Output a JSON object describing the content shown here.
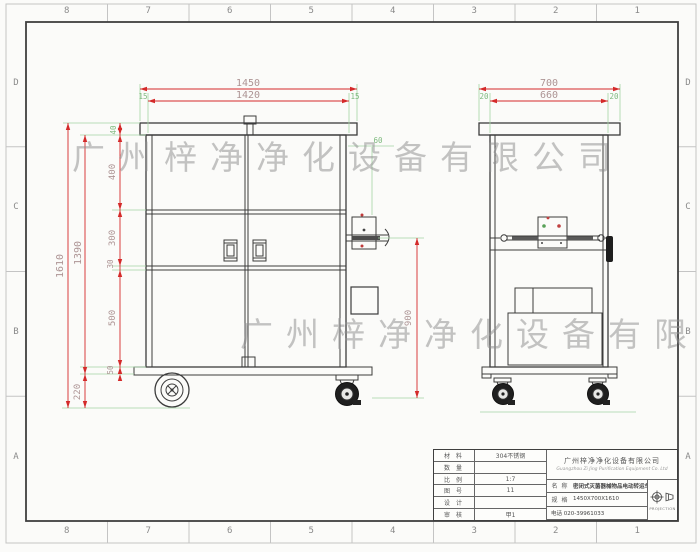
{
  "border_zones": {
    "columns": [
      "8",
      "7",
      "6",
      "5",
      "4",
      "3",
      "2",
      "1"
    ],
    "rows": [
      "D",
      "C",
      "B",
      "A"
    ]
  },
  "watermark": {
    "text": "广州梓净净化设备有限公司"
  },
  "views": {
    "front": {
      "dims": {
        "overall_width": "1450",
        "inner_width": "1420",
        "left_margin": "15",
        "right_margin": "15",
        "overall_height": "1610",
        "body_height": "1390",
        "lid_thickness": "40",
        "upper_section": "400",
        "middle_section": "300",
        "shelf_gap": "30",
        "lower_section": "500",
        "base_plate": "50",
        "wheel_height": "220",
        "handle_offset": "60",
        "door_height": "900"
      }
    },
    "side": {
      "dims": {
        "overall_depth": "700",
        "inner_depth": "660",
        "left_margin": "20",
        "right_margin": "20"
      }
    }
  },
  "title_block": {
    "rows": [
      {
        "label": "材 料",
        "value": "304不锈钢"
      },
      {
        "label": "数 量",
        "value": ""
      },
      {
        "label": "比 例",
        "value": "1:7"
      },
      {
        "label": "图 号",
        "value": "11"
      },
      {
        "label": "设 计",
        "value": ""
      },
      {
        "label": "审 核",
        "value": "甲1"
      }
    ],
    "company": "广州梓净净化设备有限公司",
    "company_en": "Guangzhou Zi Jing Purification Equipment Co. Ltd",
    "name_label": "名 称",
    "product_name": "密闭式灭菌器械物品电动转运车",
    "spec_label": "规 格",
    "spec_value": "1450X700X1610",
    "phone": "电话 020-39961033",
    "projection_label": "PROJECTION"
  },
  "colors": {
    "dimension_line": "#d42a2a",
    "extension_line": "#a4d4a4",
    "dim_text": "#ad9494",
    "dim_text_green": "#7fba7f",
    "object_line": "#3c3c3c"
  }
}
